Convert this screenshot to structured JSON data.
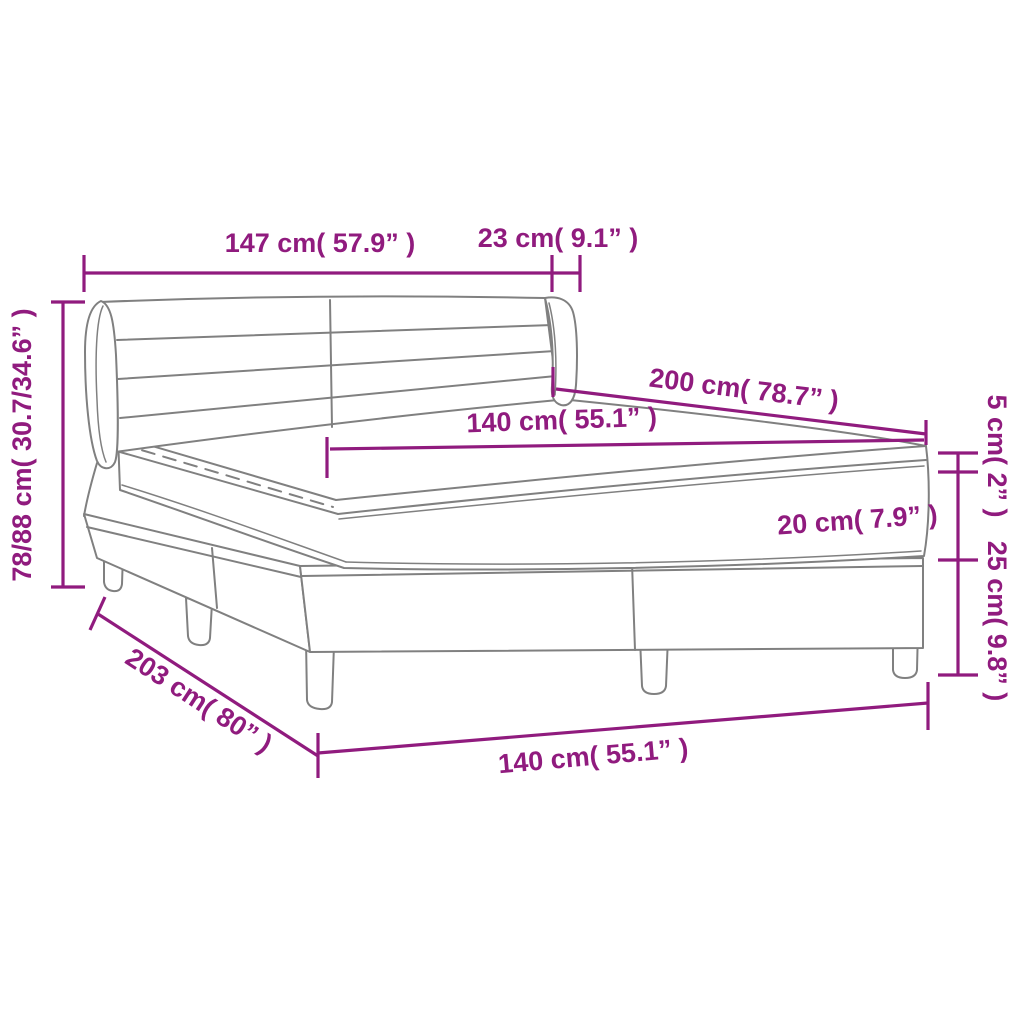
{
  "diagram": {
    "subject": "box spring bed with headboard, mattress and topper - dimension drawing"
  },
  "colors": {
    "dimension": "#901b7e",
    "line_art": "#808080",
    "background": "#ffffff"
  },
  "dims": {
    "headboard_width": "147 cm( 57.9” )",
    "headboard_wing_depth": "23 cm( 9.1” )",
    "overall_height": "78/88 cm( 30.7/34.6” )",
    "bed_length": "200 cm( 78.7” )",
    "mattress_width": "140 cm( 55.1” )",
    "mattress_thickness": "20 cm( 7.9” )",
    "topper_thickness": "5 cm( 2” )",
    "base_height": "25 cm( 9.8” )",
    "overall_length": "203 cm( 80” )",
    "base_width": "140 cm( 55.1” )"
  }
}
